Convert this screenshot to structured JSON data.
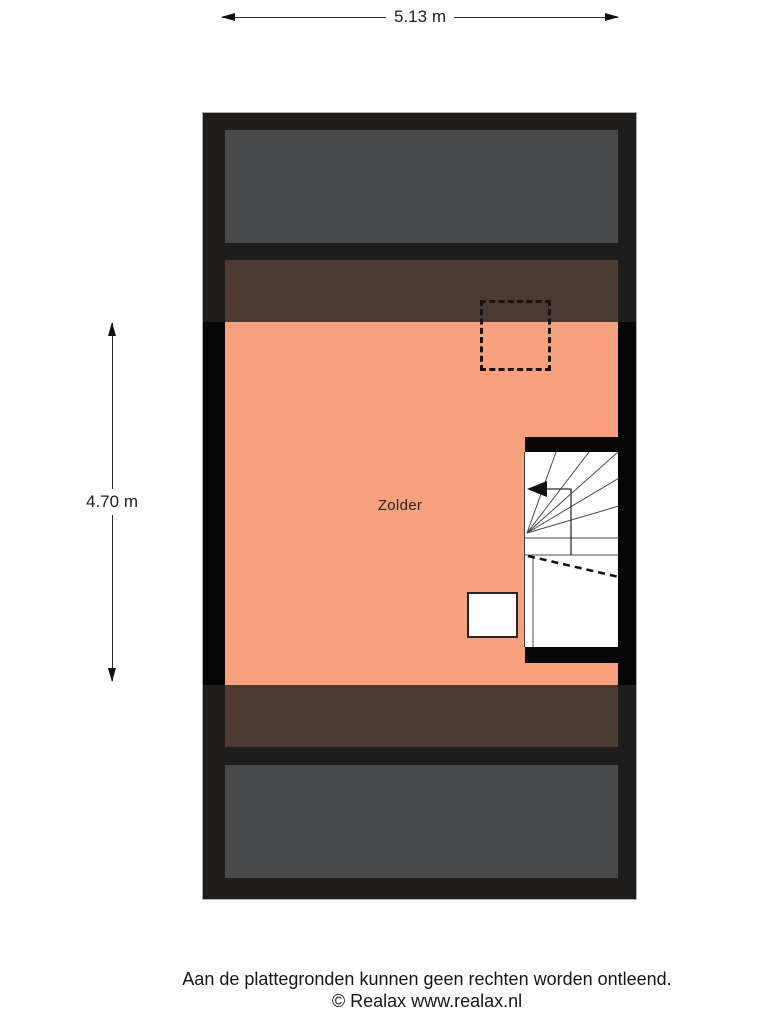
{
  "dimensions": {
    "width_label": "5.13 m",
    "height_label": "4.70 m"
  },
  "room": {
    "label": "Zolder"
  },
  "footer": {
    "disclaimer": "Aan de plattegronden kunnen geen rechten worden ontleend.",
    "copyright": "© Realax www.realax.nl"
  },
  "colors": {
    "wall_frame": "#1E1D1C",
    "wall_black": "#060606",
    "roof_gray": "#47494B",
    "strip_brown": "#4C3B32",
    "floor_salmon": "#F9A17D",
    "stair_fill": "#FFFFFF",
    "outline_gray": "#ACACAC"
  }
}
